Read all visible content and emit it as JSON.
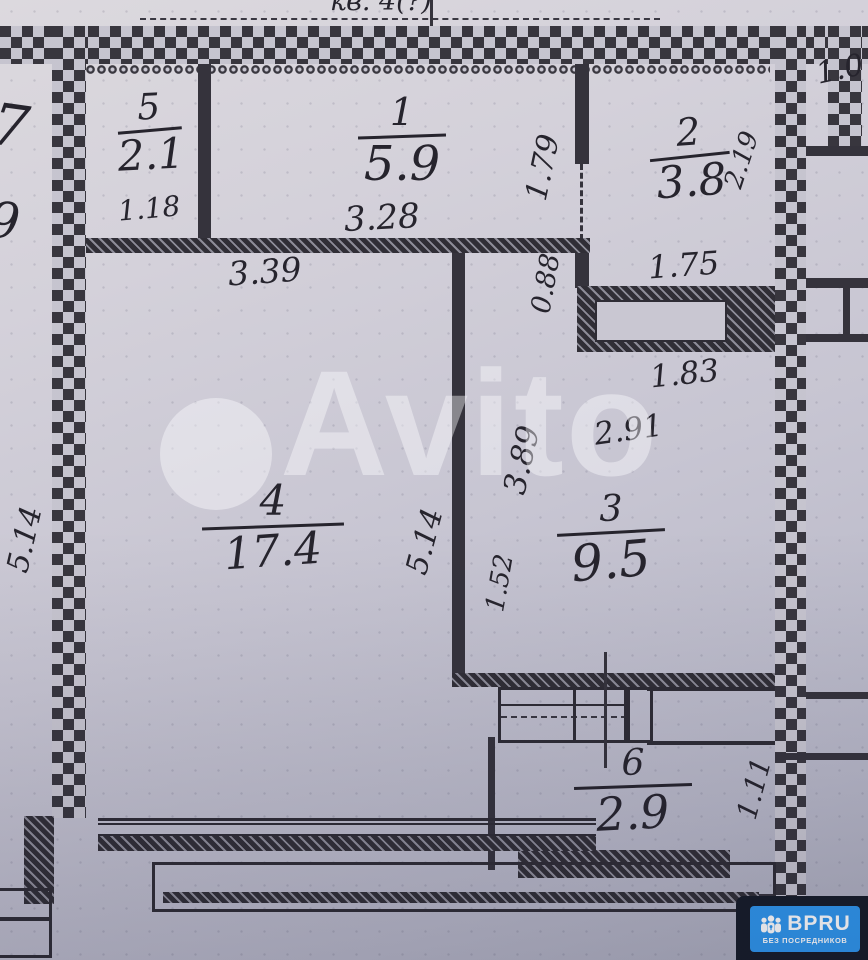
{
  "header": {
    "handwritten_note_partial": "кв. 4(?)"
  },
  "watermark": {
    "brand": "Avito"
  },
  "badge": {
    "brand": "BPRU",
    "tagline": "БЕЗ ПОСРЕДНИКОВ",
    "accent": "#2e96ed",
    "panel": "#161b27"
  },
  "rooms": {
    "r5": {
      "num": "5",
      "area": "2.1"
    },
    "r1": {
      "num": "1",
      "area": "5.9"
    },
    "r2": {
      "num": "2",
      "area": "3.8"
    },
    "r4": {
      "num": "4",
      "area": "17.4"
    },
    "r3": {
      "num": "3",
      "area": "9.5"
    },
    "r6": {
      "num": "6",
      "area": "2.9"
    }
  },
  "dimensions": {
    "room5_width": "1.18",
    "room1_width": "3.28",
    "room1_right_height": "1.79",
    "room2_width": "1.75",
    "room2_height": "2.19",
    "room2_nook_height": "0.88",
    "shaft_width": "1.83",
    "room4_top_width": "3.39",
    "room4_left_height": "5.14",
    "room4_right_height": "5.14",
    "room3_top_width": "2.91",
    "room3_left_height": "3.89",
    "room3_lower_height": "1.52",
    "room6_height": "1.11"
  },
  "partial_labels": {
    "left_top": "7",
    "left_bottom": "9",
    "top_right": "1.0"
  },
  "colors": {
    "ink": "#26242d",
    "wall": "#35333c"
  }
}
